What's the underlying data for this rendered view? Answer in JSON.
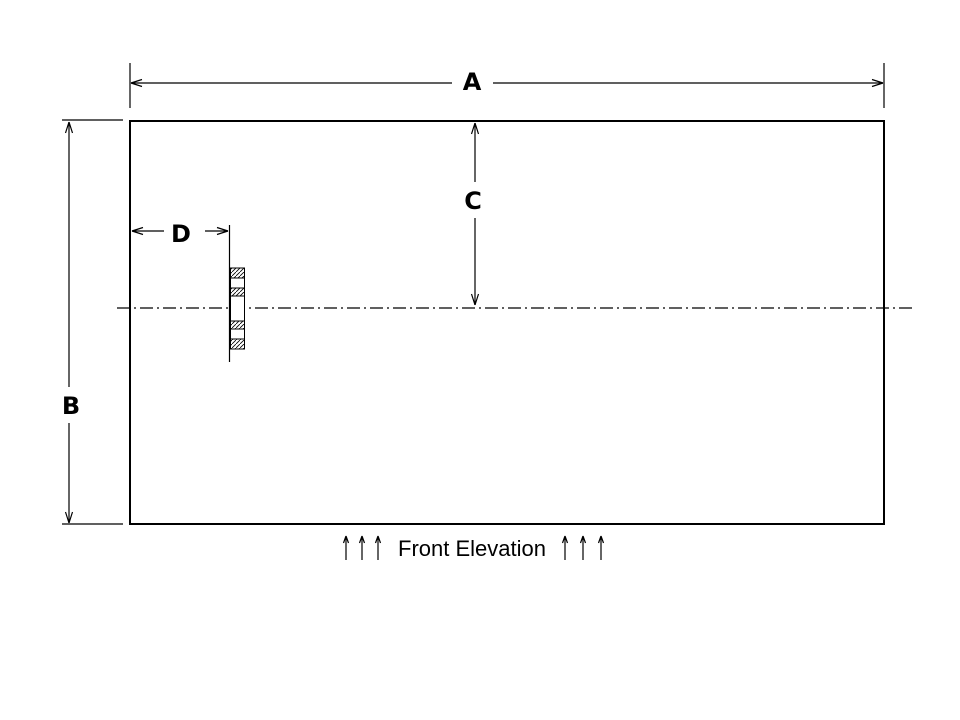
{
  "page": {
    "background_color": "#ffffff",
    "line_color": "#000000"
  },
  "drawing": {
    "caption": "Front Elevation",
    "view_type": "elevation",
    "dimensions": {
      "a": {
        "label": "A",
        "orientation": "horizontal",
        "measures": "overall width (top)"
      },
      "b": {
        "label": "B",
        "orientation": "vertical",
        "measures": "overall height (left)"
      },
      "c": {
        "label": "C",
        "orientation": "vertical",
        "measures": "top edge to centerline"
      },
      "d": {
        "label": "D",
        "orientation": "horizontal",
        "measures": "left edge to nozzle"
      }
    }
  }
}
